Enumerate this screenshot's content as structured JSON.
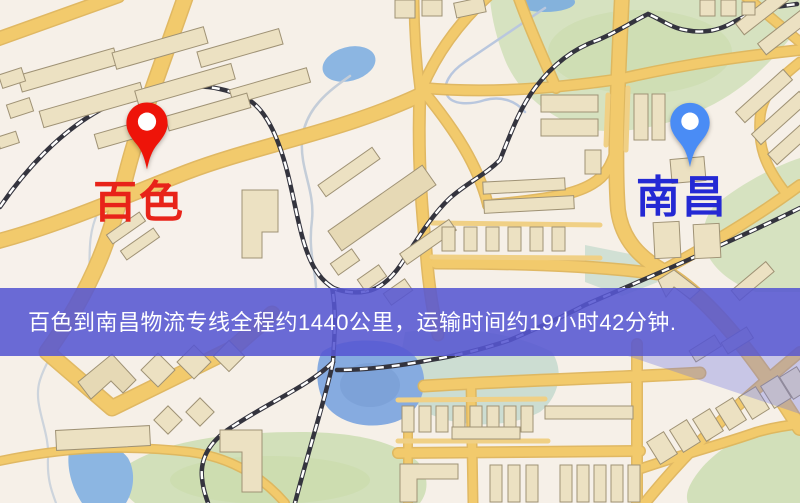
{
  "markers": {
    "origin": {
      "label": "百色",
      "pin_icon": "red-map-pin",
      "pin_color": "#ee1409",
      "label_color": "#e82319"
    },
    "destination": {
      "label": "南昌",
      "pin_icon": "blue-map-pin",
      "pin_color": "#4a8cf5",
      "label_color": "#2429d4"
    }
  },
  "banner": {
    "text": "百色到南昌物流专线全程约1440公里，运输时间约19小时42分钟.",
    "background": "rgba(86,87,209,0.88)",
    "text_color": "#ffffff"
  },
  "route": {
    "origin": "百色",
    "destination": "南昌",
    "distance_text": "约1440公里",
    "duration_text": "约19小时42分钟"
  },
  "map_style": {
    "background": "#f6f0e8",
    "road_fill": "#f2ca6c",
    "road_casing": "#dfb65c",
    "park_green": "#d6e2c0",
    "water_blue": "#8cb6e2",
    "railway_dark": "#34343e",
    "building_fill": "#ece1c2"
  }
}
